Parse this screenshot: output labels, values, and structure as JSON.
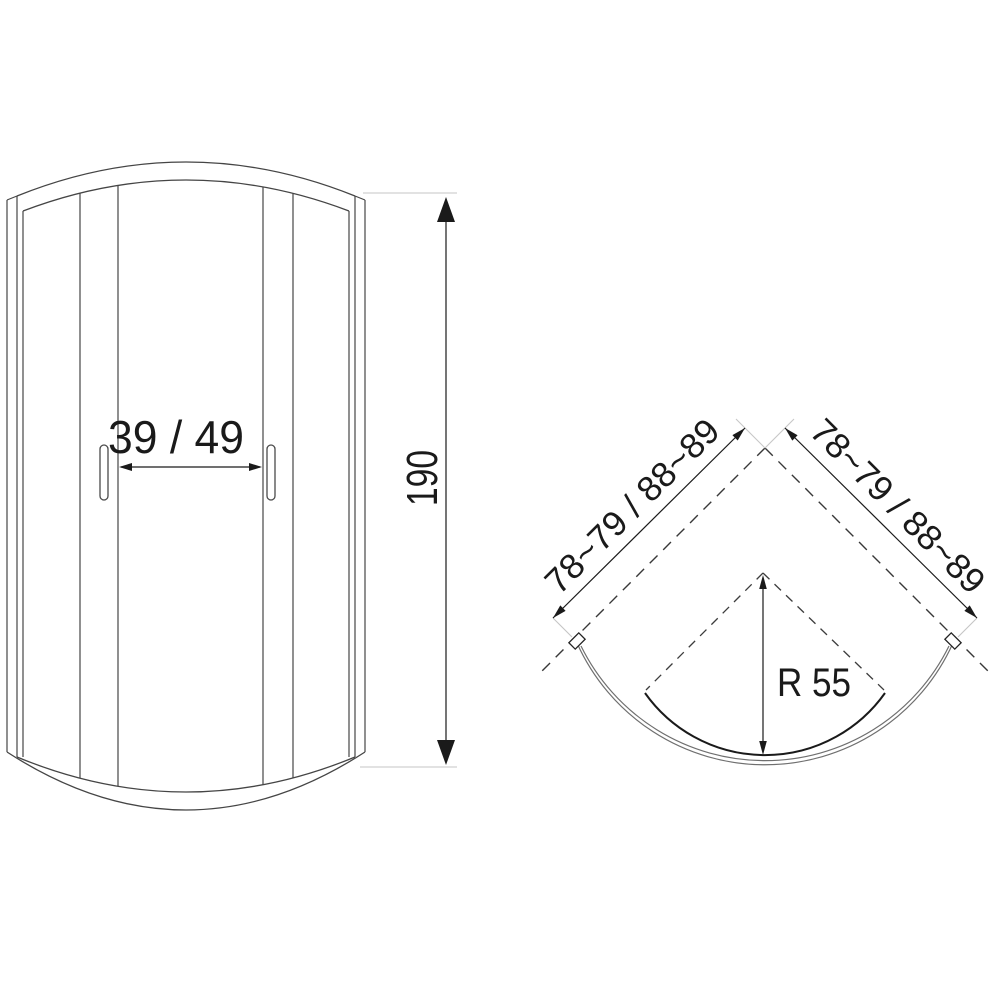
{
  "drawing": {
    "kind": "shower-enclosure-technical-drawing",
    "front_view": {
      "name": "front-elevation",
      "opening_width_label": "39 / 49",
      "height_label": "190"
    },
    "plan_view": {
      "name": "plan-view",
      "left_wall_label": "78~79 / 88~89",
      "right_wall_label": "78~79 / 88~89",
      "radius_label": "R 55"
    },
    "colors": {
      "ink": "#1a1a1a",
      "line": "#454545",
      "glass": "#6f6f6f",
      "extension": "#c6c6c6",
      "background": "#ffffff"
    }
  }
}
